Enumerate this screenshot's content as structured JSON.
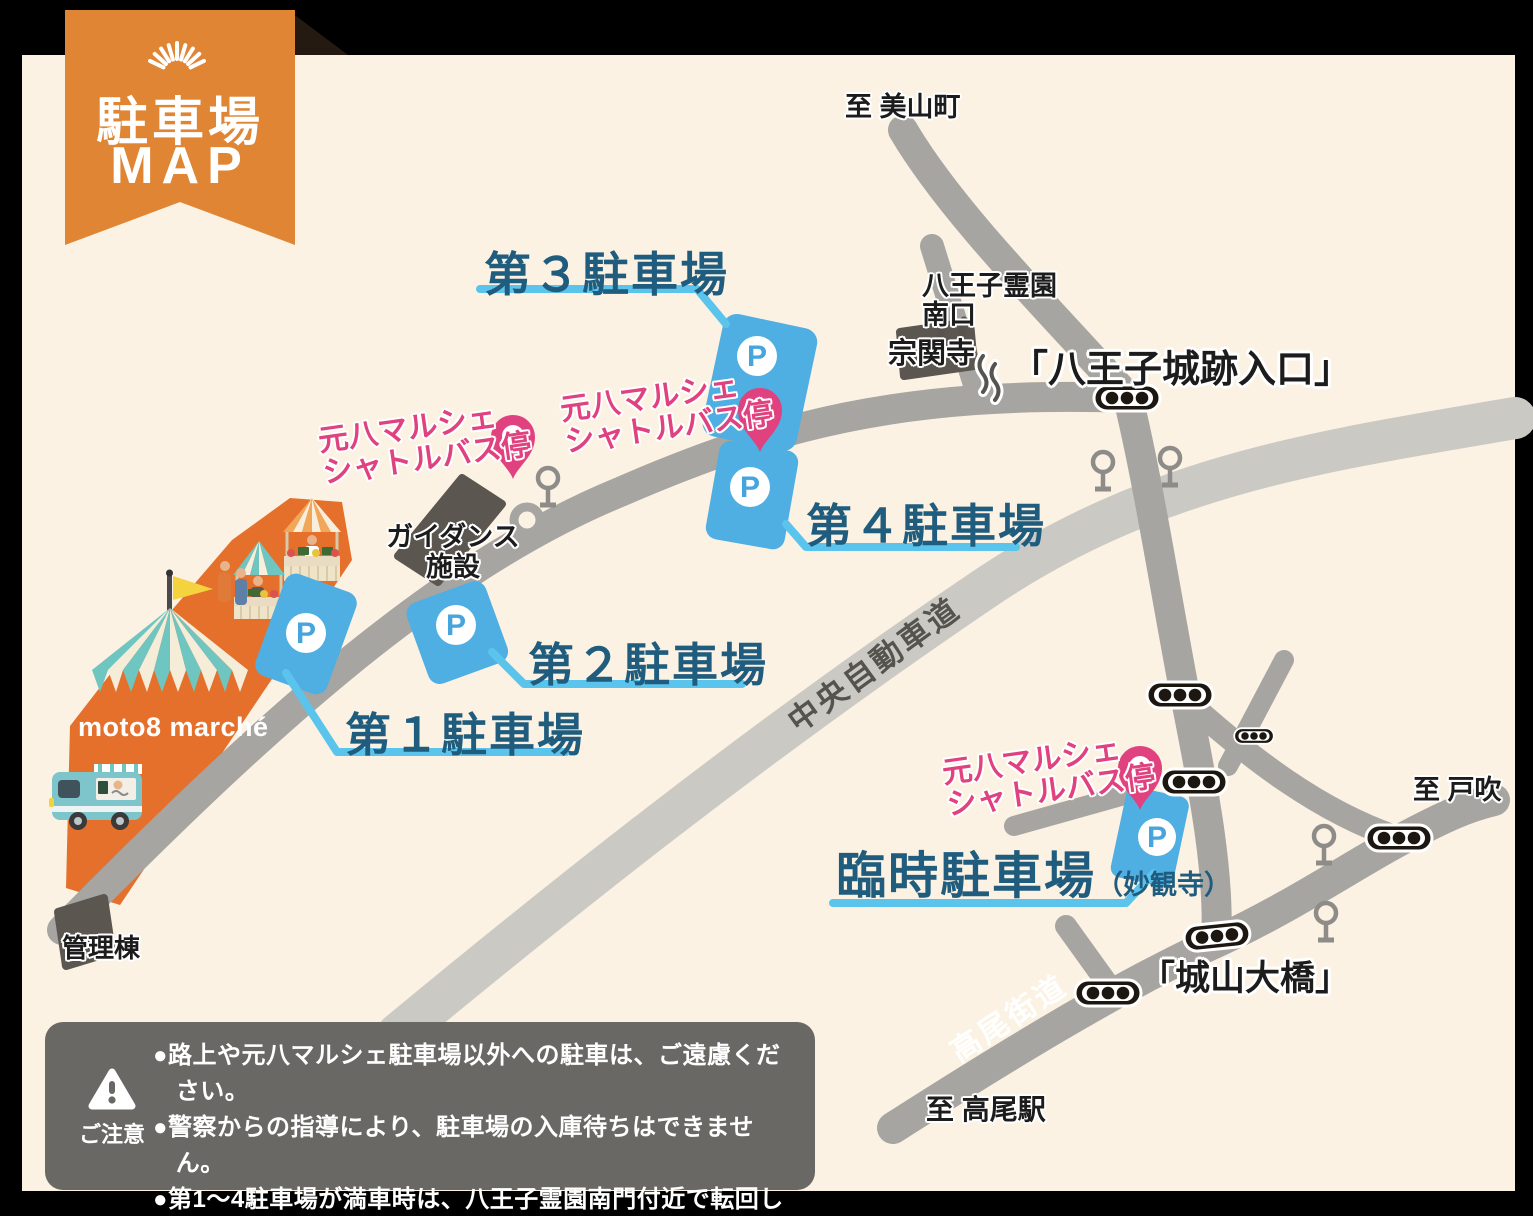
{
  "ribbon": {
    "line1": "駐車場",
    "line2": "MAP"
  },
  "parking": {
    "symbol": "P",
    "lot1": "第１駐車場",
    "lot2": "第２駐車場",
    "lot3": "第３駐車場",
    "lot4": "第４駐車場",
    "temp": "臨時駐車場",
    "temp_note": "（妙観寺）"
  },
  "shuttle": {
    "line1": "元八マルシェ",
    "line2": "シャトルバス停"
  },
  "places": {
    "miyama": "至 美山町",
    "reien_line1": "八王子霊園",
    "reien_line2": "南口",
    "sokanji": "宗関寺",
    "castle_entrance": "「八王子城跡入口」",
    "tobuki": "至 戸吹",
    "shiroyama_bridge": "「城山大橋」",
    "takao_station": "至 高尾駅",
    "guidance_line1": "ガイダンス",
    "guidance_line2": "施設",
    "kanritou": "管理棟"
  },
  "roads": {
    "expressway": "中央自動車道",
    "takao_kaido": "高尾街道"
  },
  "market": {
    "logo": "moto8 marché"
  },
  "notice": {
    "heading": "ご注意",
    "items": [
      "●路上や元八マルシェ駐車場以外への駐車は、ご遠慮ください。",
      "●警察からの指導により、駐車場の入庫待ちはできません。",
      "●第1〜4駐車場が満車時は、八王子霊園南門付近で転回していただく場合があります。予め、ご了承ください。"
    ]
  },
  "colors": {
    "background": "#000000",
    "panel": "#FBF2E3",
    "ribbon_orange": "#DF8534",
    "market_orange": "#E4702C",
    "parking_blue": "#4FAEE2",
    "label_blue": "#1F5C7E",
    "leader_blue": "#5BC4EC",
    "pink": "#E0417F",
    "road_gray": "#A7A5A1",
    "expressway_gray": "#CBC9C4",
    "building_gray": "#5B5650",
    "notice_gray": "#6A6865"
  }
}
